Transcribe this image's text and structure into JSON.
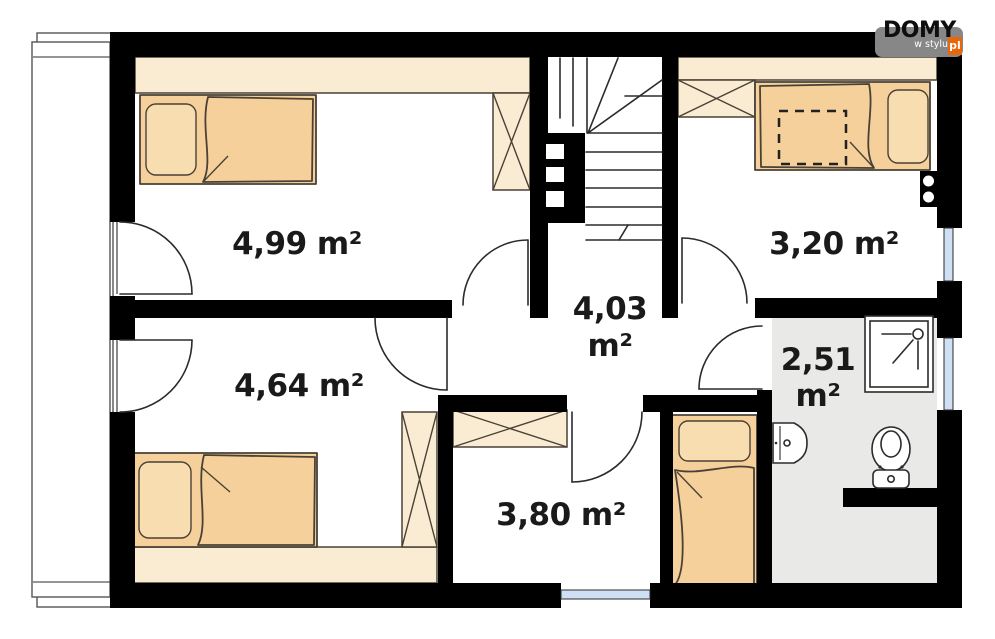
{
  "logo": {
    "brand": "DOMY",
    "tagline": "w stylu",
    "tld": "pl"
  },
  "rooms": {
    "top_left": {
      "label": "4,99 m²"
    },
    "top_right": {
      "label": "3,20 m²"
    },
    "hall": {
      "value": "4,03",
      "unit": "m²"
    },
    "bottom_left": {
      "label": "4,64 m²"
    },
    "bottom_middle": {
      "label": "3,80 m²"
    },
    "bathroom": {
      "value": "2,51",
      "unit": "m²"
    }
  },
  "colors": {
    "wall": "#000000",
    "line": "#2b2b2b",
    "furniture_outline": "#4a4136",
    "wardrobe_fill": "#f9ecd2",
    "bed_fill": "#f5d09b",
    "bed_pillow": "#f8ddb0",
    "bathroom_floor": "#e9e9e7",
    "window_glass": "#cfe0f4",
    "label_text": "#1a1a1a",
    "logo_bg": "#878787",
    "logo_orange": "#e8670c",
    "logo_text": "#0e0e0e"
  }
}
